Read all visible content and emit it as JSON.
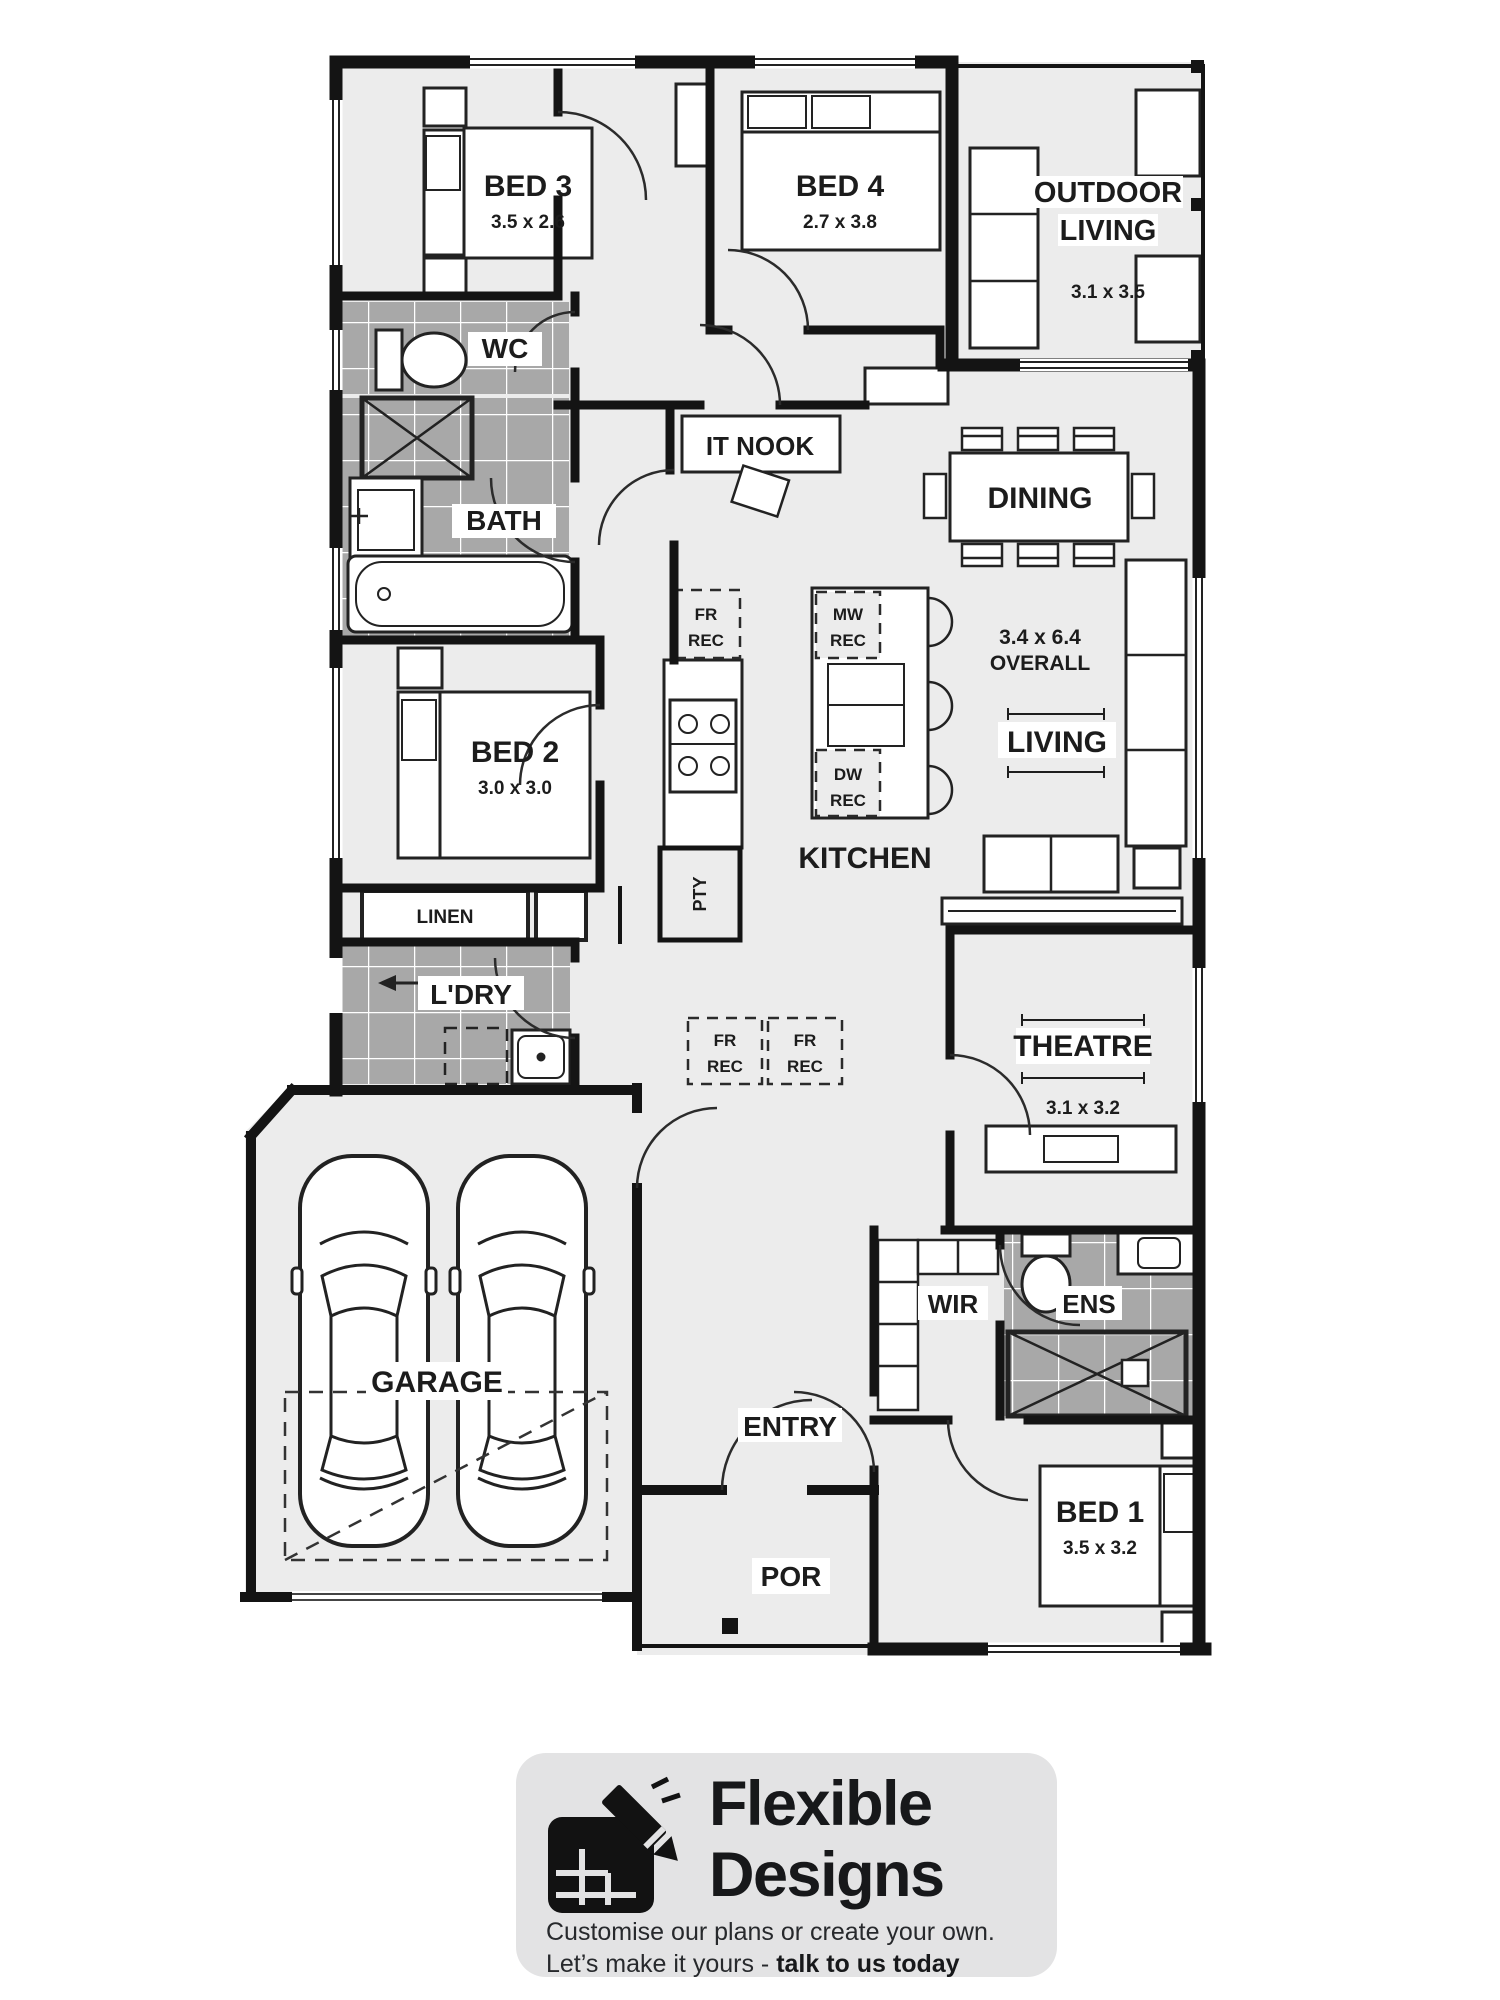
{
  "plan": {
    "rooms": {
      "bed3": {
        "label": "BED 3",
        "dim": "3.5 x 2.6"
      },
      "bed4": {
        "label": "BED 4",
        "dim": "2.7 x 3.8"
      },
      "outdoor_living": {
        "label_line1": "OUTDOOR",
        "label_line2": "LIVING",
        "dim": "3.1 x 3.5"
      },
      "wc": {
        "label": "WC"
      },
      "bath": {
        "label": "BATH"
      },
      "it_nook": {
        "label": "IT NOOK"
      },
      "dining": {
        "label": "DINING"
      },
      "living": {
        "label": "LIVING",
        "overall_dim": "3.4 x 6.4",
        "overall_word": "OVERALL"
      },
      "kitchen": {
        "label": "KITCHEN"
      },
      "pantry": {
        "label": "PTY"
      },
      "bed2": {
        "label": "BED 2",
        "dim": "3.0 x 3.0"
      },
      "linen": {
        "label": "LINEN"
      },
      "laundry": {
        "label": "L'DRY"
      },
      "theatre": {
        "label": "THEATRE",
        "dim": "3.1 x 3.2"
      },
      "garage": {
        "label": "GARAGE"
      },
      "wir": {
        "label": "WIR"
      },
      "ens": {
        "label": "ENS"
      },
      "entry": {
        "label": "ENTRY"
      },
      "bed1": {
        "label": "BED 1",
        "dim": "3.5 x 3.2"
      },
      "porch": {
        "label": "POR"
      }
    },
    "recesses": {
      "fr_line1": "FR",
      "fr_line2": "REC",
      "mw_line1": "MW",
      "mw_line2": "REC",
      "dw_line1": "DW",
      "dw_line2": "REC"
    }
  },
  "footer": {
    "brand_line1": "Flexible",
    "brand_line2": "Designs",
    "tagline": "Customise our plans or create your own.",
    "cta_prefix": "Let’s make it yours - ",
    "cta_bold": "talk to us today"
  },
  "colors": {
    "floor": "#ececec",
    "tile": "#a8a8a8",
    "wall": "#141414",
    "footer_bg": "#e3e3e4"
  }
}
